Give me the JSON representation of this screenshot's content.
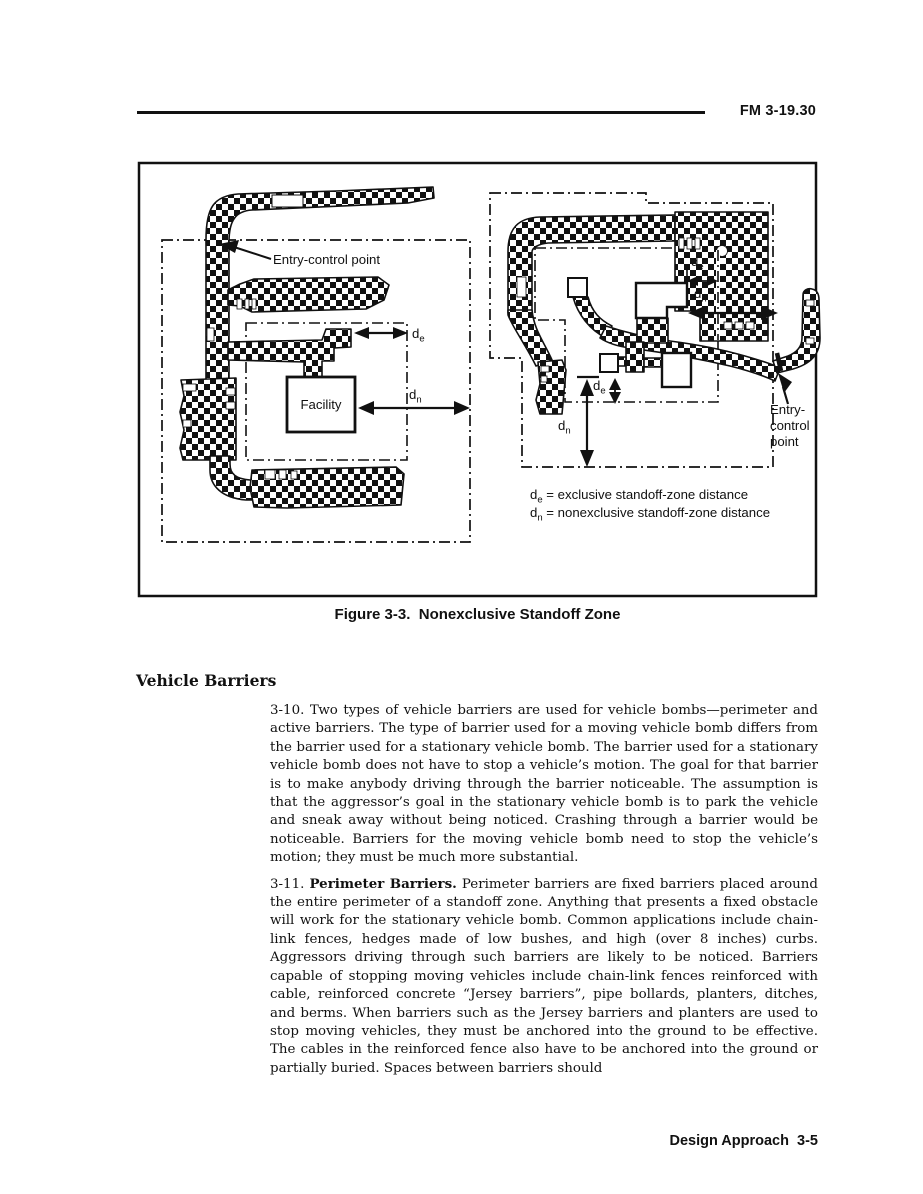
{
  "header": {
    "doc_number": "FM 3-19.30"
  },
  "footer": {
    "text": "Design Approach  3-5"
  },
  "figure": {
    "caption": "Figure 3-3.  Nonexclusive Standoff Zone",
    "labels": {
      "entry_control_left": "Entry-control point",
      "entry_control_right": [
        "Entry-",
        "control",
        "point"
      ],
      "facility": "Facility",
      "d": "d",
      "sub_e": "e",
      "sub_n": "n",
      "legend_e_rest": " = exclusive standoff-zone distance",
      "legend_n_rest": " = nonexclusive standoff-zone distance"
    }
  },
  "section": {
    "heading": "Vehicle Barriers",
    "para_310": "3-10.  Two types of vehicle barriers are used for vehicle bombs—perimeter and active barriers. The type of barrier used for a moving vehicle bomb differs from the barrier used for a stationary vehicle bomb. The barrier used for a stationary vehicle bomb does not have to stop a vehicle’s motion. The goal for that barrier is to make anybody driving through the barrier noticeable. The assumption is that the aggressor’s goal in the stationary vehicle bomb is to park the vehicle and sneak away without being noticed. Crashing through a barrier would be noticeable. Barriers for the moving vehicle bomb need to stop the vehicle’s motion; they must be much more substantial.",
    "para_311_num": "3-11.  ",
    "para_311_bold": "Perimeter Barriers.",
    "para_311_rest": " Perimeter barriers are fixed barriers placed around the entire perimeter of a standoff zone. Anything that presents a fixed obstacle will work for the stationary vehicle bomb. Common applications include chain-link fences, hedges made of low bushes, and high (over 8 inches) curbs. Aggressors driving through such barriers are likely to be noticed. Barriers capable of stopping moving vehicles include chain-link fences reinforced with cable, reinforced concrete “Jersey barriers”, pipe bollards, planters, ditches, and berms. When barriers such as the Jersey barriers and planters are used to stop moving vehicles, they must be anchored into the ground to be effective. The cables in the reinforced fence also have to be anchored into the ground or partially buried. Spaces between barriers should"
  }
}
